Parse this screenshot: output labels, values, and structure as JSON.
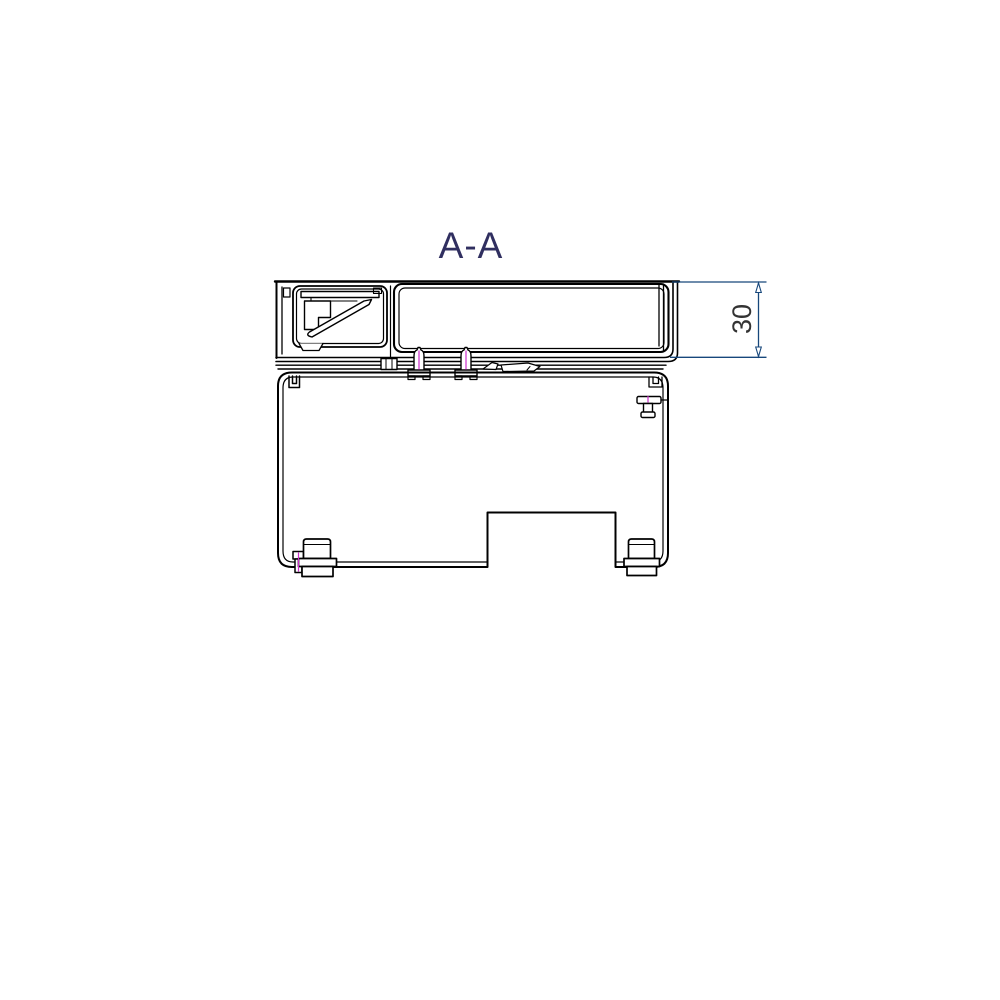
{
  "window": {
    "background": "#ffffff"
  },
  "drawing": {
    "section_label": "A-A",
    "dimension_value": "30",
    "colors": {
      "outline": "#000000",
      "dimension_line": "#17477b",
      "dimension_text": "#333333",
      "section_label_color": "#302f60",
      "centerline": "#cc2fcb",
      "fill": "#ffffff"
    }
  }
}
